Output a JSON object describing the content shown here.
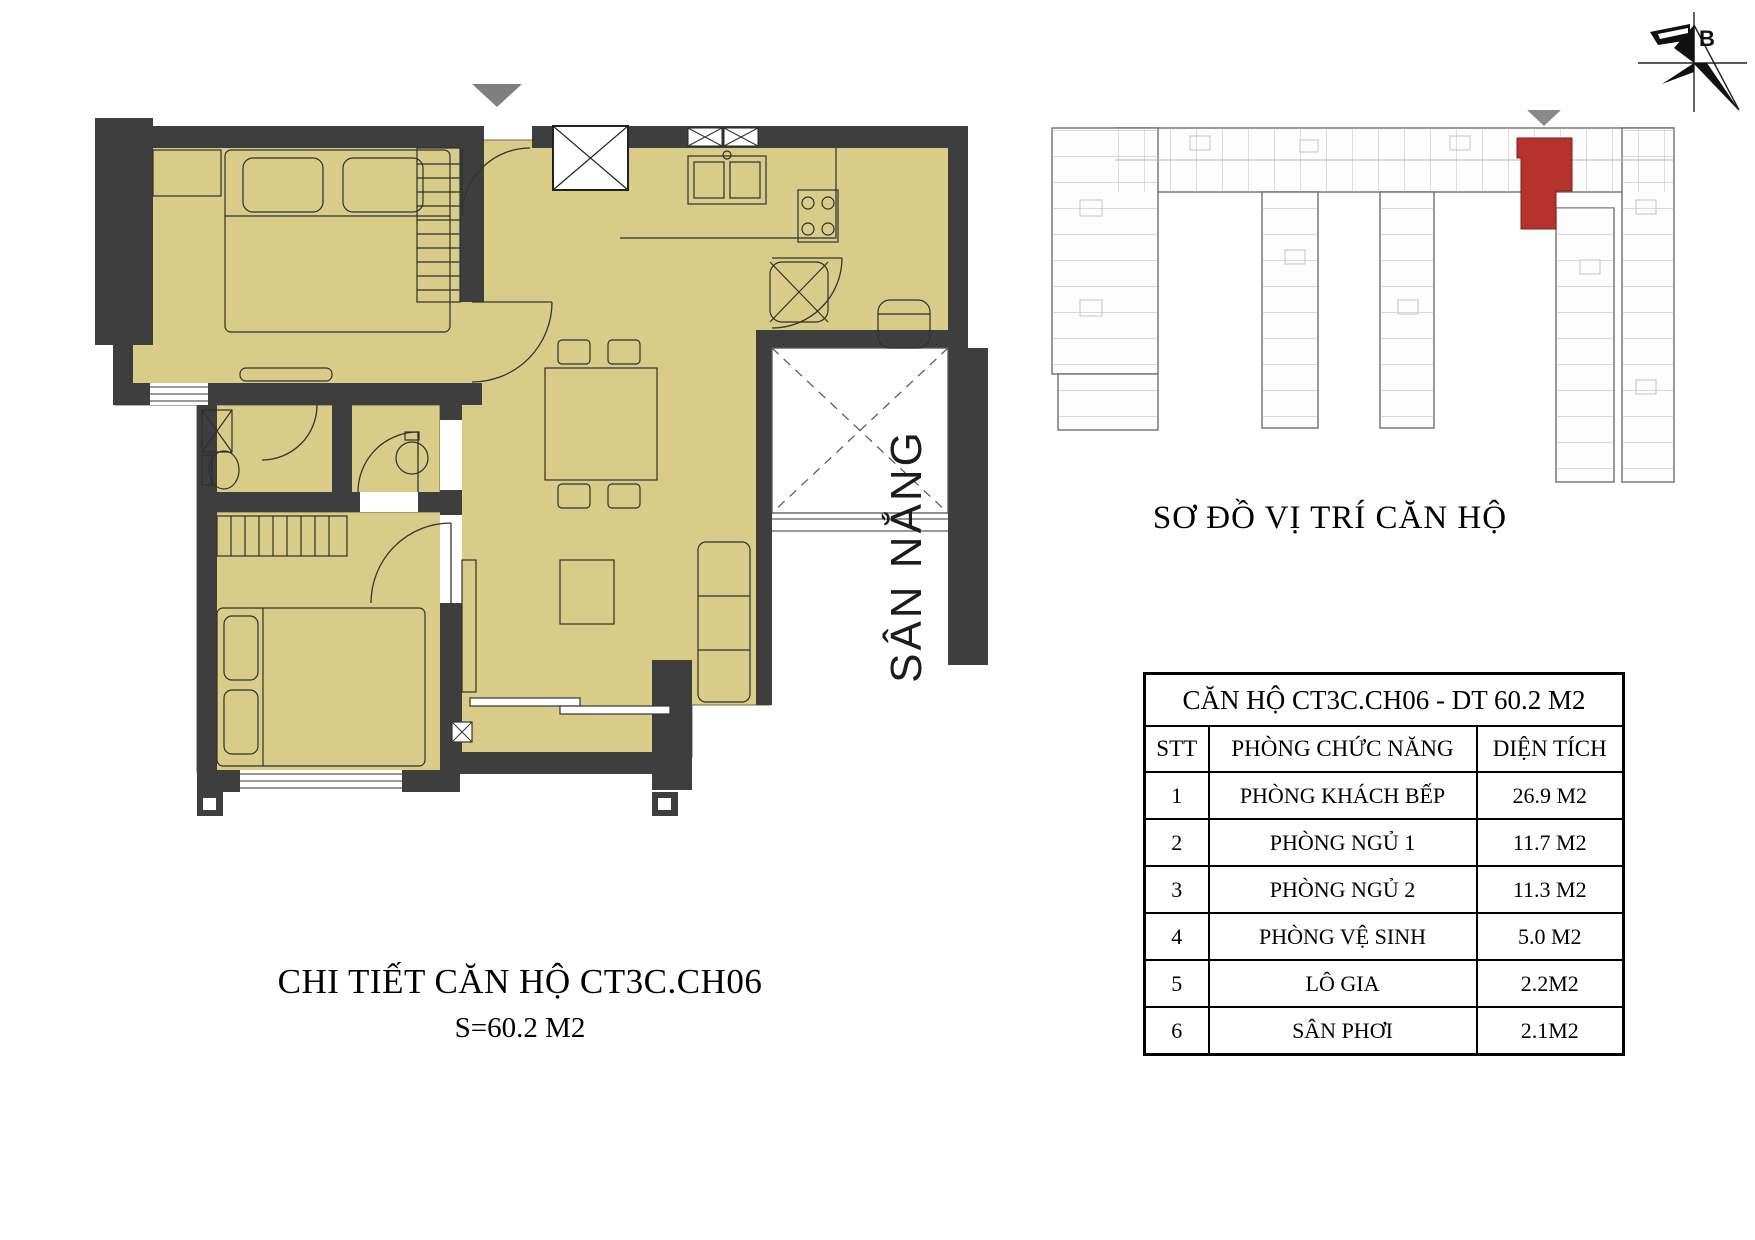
{
  "compass": {
    "label": "B"
  },
  "floor_plan": {
    "title": "CHI TIẾT CĂN HỘ CT3C.CH06",
    "subtitle": "S=60.2 M2",
    "sun_yard_label": "SÂN NẮNG"
  },
  "location_map": {
    "title": "SƠ ĐỒ VỊ TRÍ CĂN HỘ"
  },
  "table": {
    "title": "CĂN HỘ CT3C.CH06 - DT 60.2 M2",
    "columns": [
      "STT",
      "PHÒNG CHỨC NĂNG",
      "DIỆN TÍCH"
    ],
    "rows": [
      {
        "stt": "1",
        "room": "PHÒNG KHÁCH BẾP",
        "area": "26.9 M2"
      },
      {
        "stt": "2",
        "room": "PHÒNG NGỦ 1",
        "area": "11.7 M2"
      },
      {
        "stt": "3",
        "room": "PHÒNG NGỦ 2",
        "area": "11.3 M2"
      },
      {
        "stt": "4",
        "room": "PHÒNG VỆ SINH",
        "area": "5.0 M2"
      },
      {
        "stt": "5",
        "room": "LÔ GIA",
        "area": "2.2M2"
      },
      {
        "stt": "6",
        "room": "SÂN PHƠI",
        "area": "2.1M2"
      }
    ]
  },
  "colors": {
    "floor": "#d9cc88",
    "wall": "#3e3e3e",
    "highlight_unit": "#b5322d"
  }
}
